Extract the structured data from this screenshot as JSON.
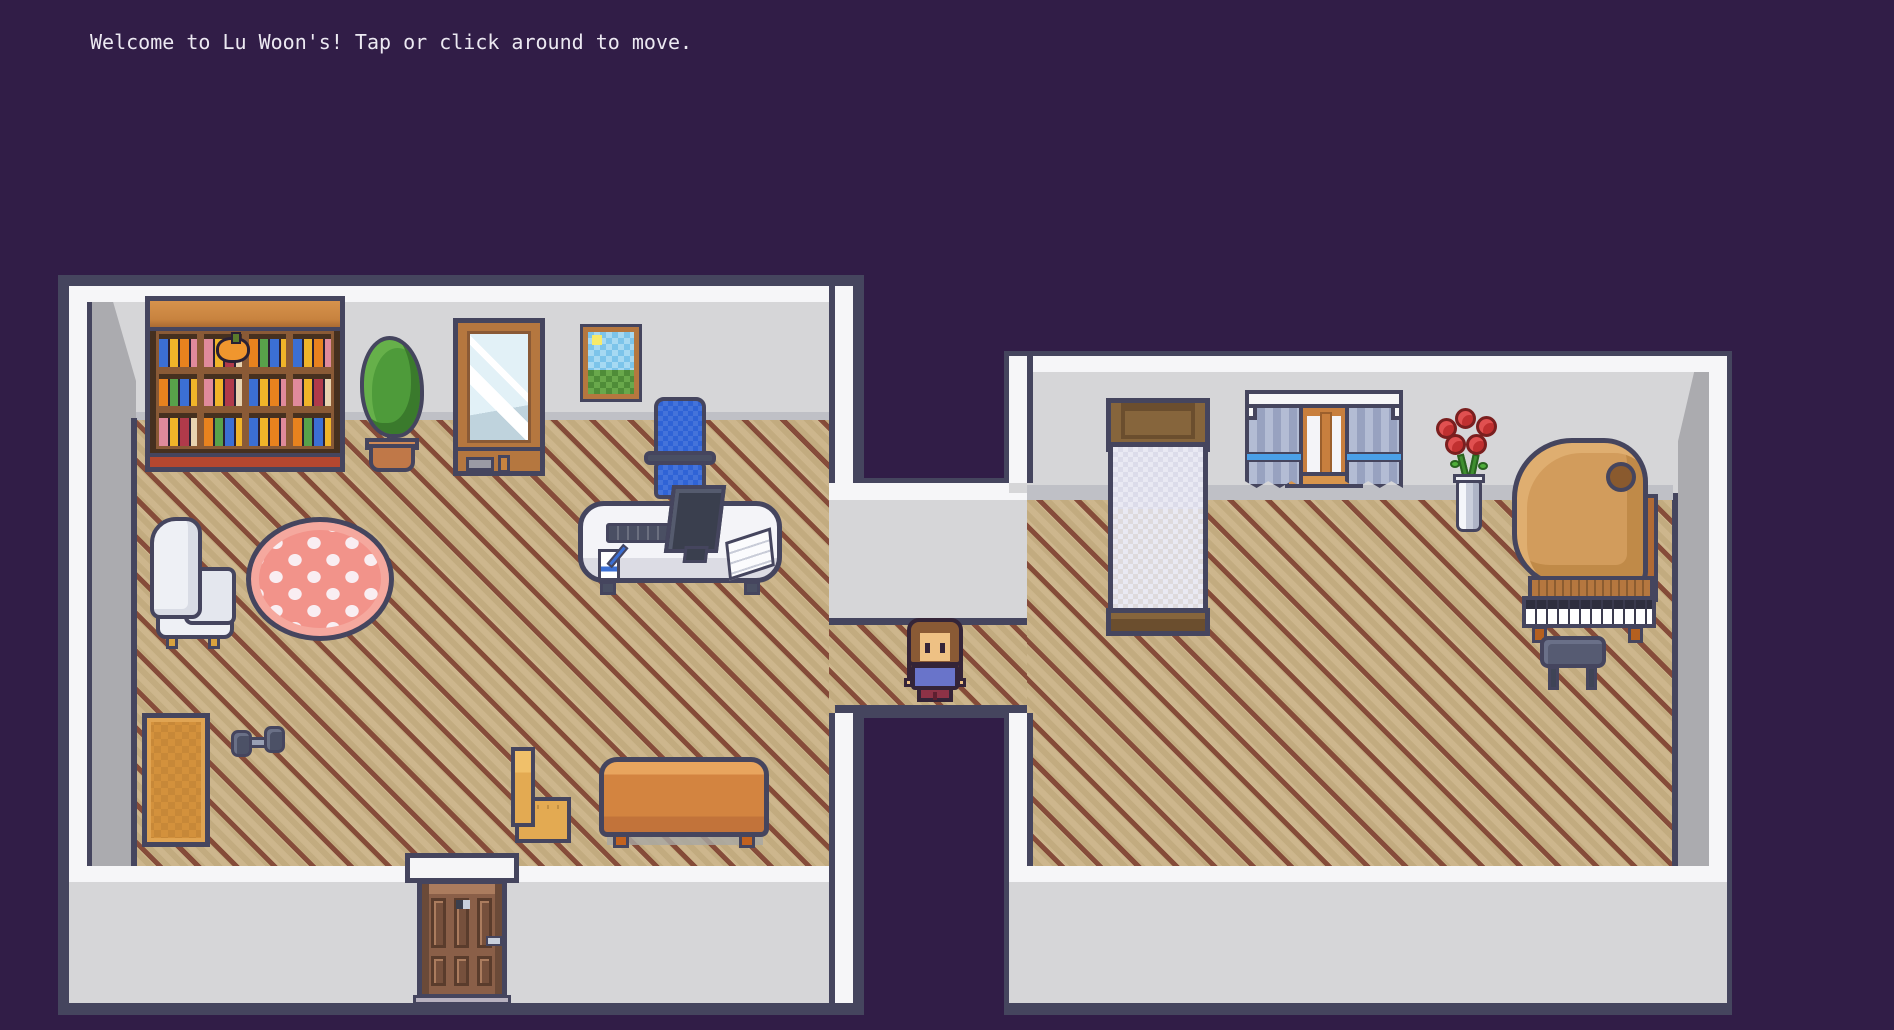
{
  "scene": {
    "welcome_message": "Welcome to Lu Woon's! Tap or click around to move."
  },
  "palette": {
    "background": "#311d47",
    "outline": "#45455e",
    "wall": "#d6d6d8",
    "wall_trim": "#f6f6f8",
    "wall_shade": "#ababaf",
    "floor": "#c9b184",
    "floor_stripe": "#7a3a2c",
    "wood": "#c8833f",
    "rug_pink": "#f2938a",
    "office_chair_blue": "#2f63d6",
    "curtain_tie_blue": "#4aa0e8",
    "rose_red": "#c03030"
  },
  "player": {
    "sprite": "villager-facing-down",
    "hair_color": "#8a5a35",
    "shirt_color": "#6974ca",
    "pants_color": "#8e3246"
  },
  "rooms": {
    "left_room": {
      "furniture": [
        "bookshelf",
        "potted-plant",
        "standing-mirror",
        "landscape-painting",
        "office-chair",
        "computer-desk",
        "armchair",
        "round-rug",
        "exercise-mat",
        "dumbbell",
        "wooden-chair",
        "couch",
        "front-door"
      ]
    },
    "hallway": {
      "furniture": []
    },
    "right_room": {
      "furniture": [
        "bed",
        "curtained-window",
        "rose-vase",
        "grand-piano",
        "piano-stool"
      ]
    }
  }
}
